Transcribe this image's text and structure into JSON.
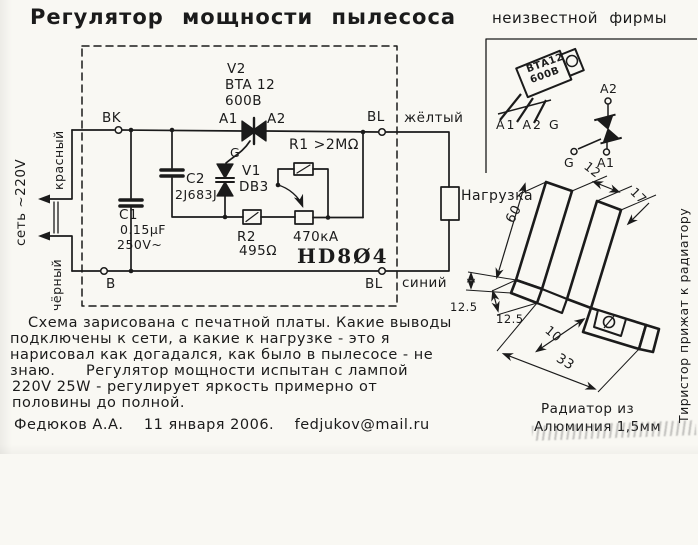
{
  "title": "Регулятор мощности пылесоса",
  "brand_note": "неизвестной фирмы",
  "mount_note": {
    "line1": "Тиристор прижат к радиатору",
    "line2": "через теплопроводящую пасту."
  },
  "package": {
    "marking1": "ВТА12",
    "marking2": "600В",
    "pins": "A1 A2 G"
  },
  "pinout": {
    "a2": "A2",
    "g": "G",
    "a1": "A1"
  },
  "heatsink": {
    "d60": "60",
    "d12": "12",
    "d17": "17",
    "d125a": "12.5",
    "d125b": "12.5",
    "d10": "10",
    "d33": "33",
    "caption1": "Радиатор из",
    "caption2": "Алюминия 1,5мм"
  },
  "schematic": {
    "mains": "сеть ~220V",
    "wire_red": "красный",
    "wire_black": "чёрный",
    "wire_yellow": "жёлтый",
    "wire_blue": "синий",
    "bk": "BK",
    "b": "B",
    "bl_top": "BL",
    "bl_bottom": "BL",
    "load": "Нагрузка",
    "board": "HD8Ø4",
    "v2_des": "V2",
    "v2_type": "BTA 12",
    "v2_volt": "600В",
    "a1": "A1",
    "a2": "A2",
    "g": "G",
    "v1_des": "V1",
    "v1_type": "DB3",
    "c1_des": "C1",
    "c1_val": "0.15μF",
    "c1_volt": "250V~",
    "c2_des": "C2",
    "c2_val": "2J683J",
    "r1": "R1 >2МΩ",
    "r2_des": "R2",
    "r2_val": "495Ω",
    "pot": "470кА"
  },
  "footer": {
    "line1": "Схема зарисована с печатной платы. Какие выводы",
    "line2": "подключены к сети, а какие к нагрузке - это я",
    "line3": "нарисовал как догадался, как было в пылесосе - не",
    "line4": "знаю.      Регулятор мощности испытан с лампой",
    "line5": "220V 25W - регулирует яркость примерно от",
    "line6": "половины до полной.",
    "signature": "Федюков А.А.    11 января 2006.    fedjukov@mail.ru"
  }
}
